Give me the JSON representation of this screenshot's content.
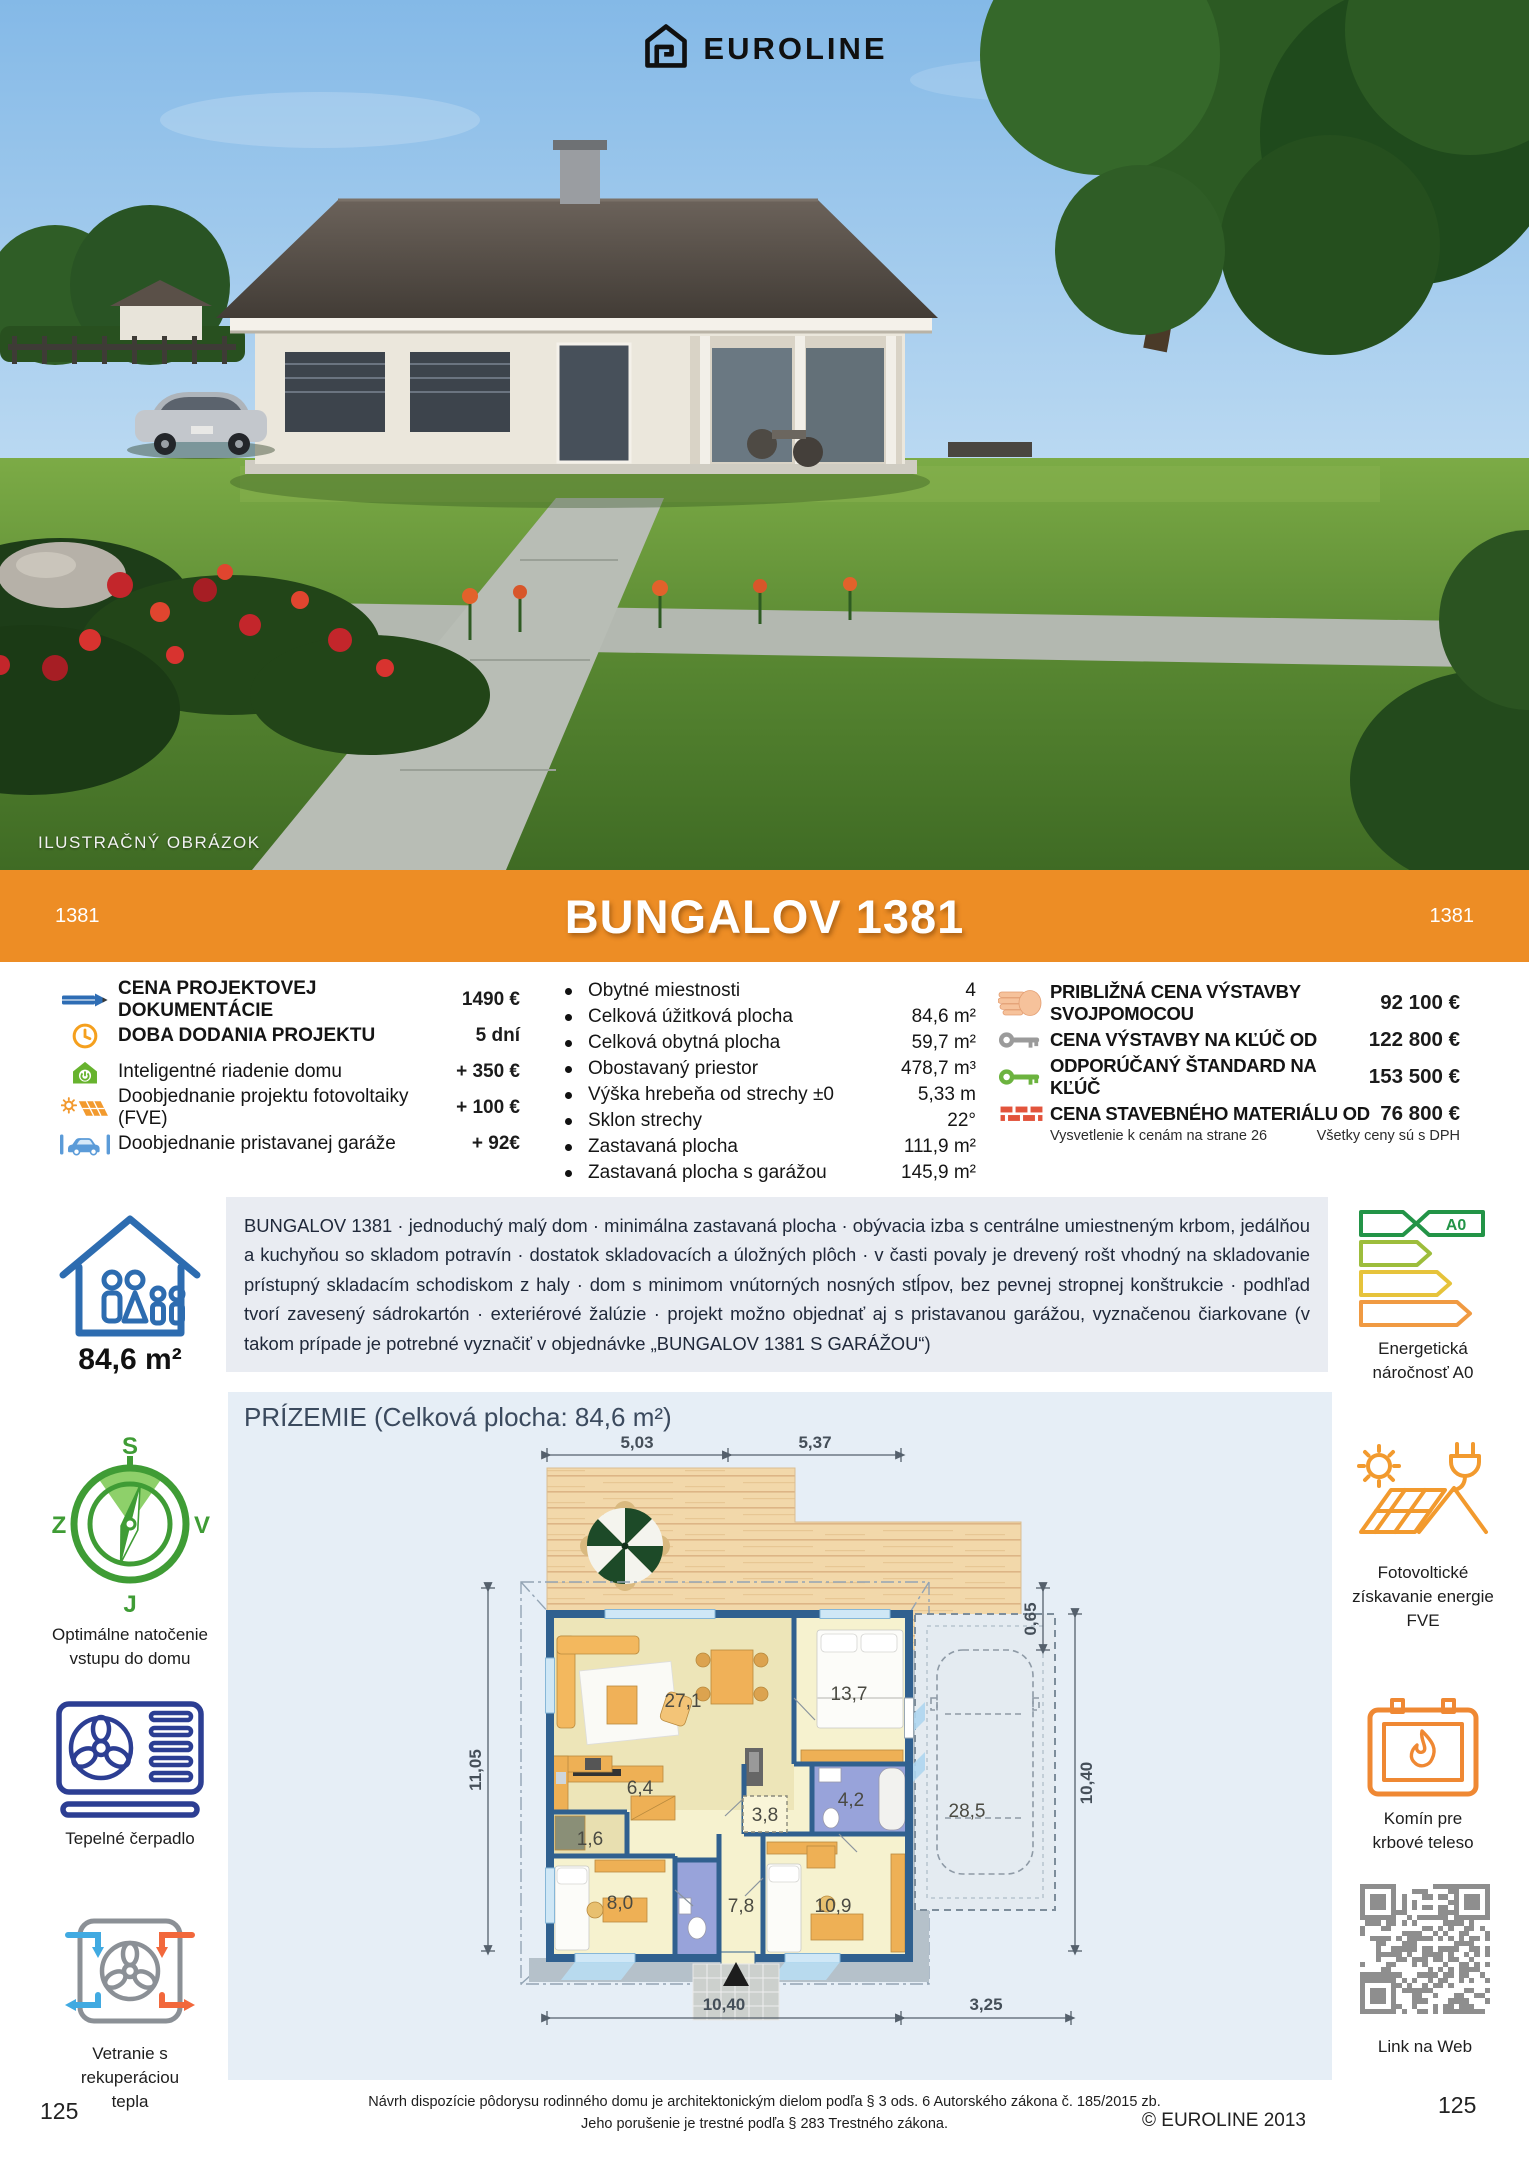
{
  "brand": {
    "name": "EUROLINE"
  },
  "photo": {
    "caption": "ILUSTRAČNÝ OBRÁZOK"
  },
  "banner": {
    "title": "BUNGALOV 1381",
    "code_left": "1381",
    "code_right": "1381"
  },
  "options": {
    "rows": [
      {
        "icon": "pencil-icon",
        "label": "CENA PROJEKTOVEJ DOKUMENTÁCIE",
        "value": "1490 €"
      },
      {
        "icon": "clock-icon",
        "label": "DOBA DODANIA PROJEKTU",
        "value": "5 dní"
      },
      {
        "icon": "smart-home-icon",
        "label": "Inteligentné riadenie domu",
        "value": "+ 350 €"
      },
      {
        "icon": "solar-icon",
        "label": "Doobjednanie projektu fotovoltaiky (FVE)",
        "value": "+ 100 €"
      },
      {
        "icon": "garage-car-icon",
        "label": "Doobjednanie pristavanej garáže",
        "value": "+ 92€"
      }
    ]
  },
  "specs": {
    "rows": [
      {
        "label": "Obytné miestnosti",
        "value": "4"
      },
      {
        "label": "Celková úžitková plocha",
        "value": "84,6 m²"
      },
      {
        "label": "Celková obytná plocha",
        "value": "59,7 m²"
      },
      {
        "label": "Obostavaný priestor",
        "value": "478,7 m³"
      },
      {
        "label": "Výška hrebeňa od strechy ±0",
        "value": "5,33 m"
      },
      {
        "label": "Sklon strechy",
        "value": "22°"
      },
      {
        "label": "Zastavaná plocha",
        "value": "111,9 m²"
      },
      {
        "label": "Zastavaná plocha s garážou",
        "value": "145,9 m²"
      }
    ]
  },
  "prices": {
    "rows": [
      {
        "icon": "hand-icon",
        "label": "PRIBLIŽNÁ CENA VÝSTAVBY SVOJPOMOCOU",
        "value": "92 100 €"
      },
      {
        "icon": "key-gray-icon",
        "label": "CENA VÝSTAVBY NA KĽÚČ OD",
        "value": "122 800 €"
      },
      {
        "icon": "key-green-icon",
        "label": "ODPORÚČANÝ ŠTANDARD NA KĽÚČ",
        "value": "153 500 €"
      },
      {
        "icon": "bricks-icon",
        "label": "CENA STAVEBNÉHO MATERIÁLU OD",
        "value": "76 800 €"
      }
    ],
    "note_left": "Vysvetlenie k cenám na strane 26",
    "note_right": "Všetky ceny sú s DPH"
  },
  "area": {
    "value": "84,6 m²"
  },
  "description": "BUNGALOV 1381 · jednoduchý malý dom · minimálna zastavaná plocha · obývacia izba s centrálne umiestneným krbom, jedálňou a kuchyňou so skladom potravín · dostatok skladovacích a úložných plôch · v časti povaly je drevený rošt vhodný na skladovanie prístupný skladacím schodiskom z haly · dom s minimom vnútorných nosných stĺpov, bez pevnej stropnej konštrukcie · podhľad tvorí zavesený sádrokartón · exteriérové žalúzie ·  projekt možno objednať aj s pristavanou garážou, vyznačenou čiarkovane (v takom prípade je potrebné vyznačiť v objednávke „BUNGALOV 1381 S GARÁŽOU“)",
  "compass": {
    "n": "S",
    "s": "J",
    "w": "Z",
    "e": "V"
  },
  "sidebar_left": {
    "compass_label": "Optimálne natočenie vstupu do domu",
    "heatpump_label": "Tepelné čerpadlo",
    "ventilation_label": "Vetranie s rekuperáciou tepla"
  },
  "sidebar_right": {
    "energy_label": "Energetická náročnosť A0",
    "energy_badge": "A0",
    "pv_label": "Fotovoltické získavanie energie FVE",
    "fireplace_label": "Komín pre krbové teleso",
    "qr_label": "Link na Web"
  },
  "floorplan": {
    "heading": "PRÍZEMIE (Celková plocha: 84,6 m²)",
    "rooms": {
      "living": "27,1",
      "bedroom1": "13,7",
      "kitchen": "6,4",
      "pantry": "1,6",
      "hatch": "3,8",
      "bath": "4,2",
      "bedroom2": "8,0",
      "corridor": "7,8",
      "bedroom3": "10,9",
      "garage": "28,5"
    },
    "dims": {
      "top_left": "5,03",
      "top_right": "5,37",
      "left": "11,05",
      "right_small": "0,65",
      "right": "10,40",
      "bottom_left": "10,40",
      "bottom_right": "3,25"
    }
  },
  "footer": {
    "legal1": "Návrh dispozície pôdorysu rodinného domu je architektonickým dielom podľa § 3 ods. 6 Autorského zákona č. 185/2015 zb.",
    "legal2": "Jeho porušenie je trestné podľa § 283 Trestného zákona.",
    "copyright": "© EUROLINE 2013",
    "page_left": "125",
    "page_right": "125"
  }
}
